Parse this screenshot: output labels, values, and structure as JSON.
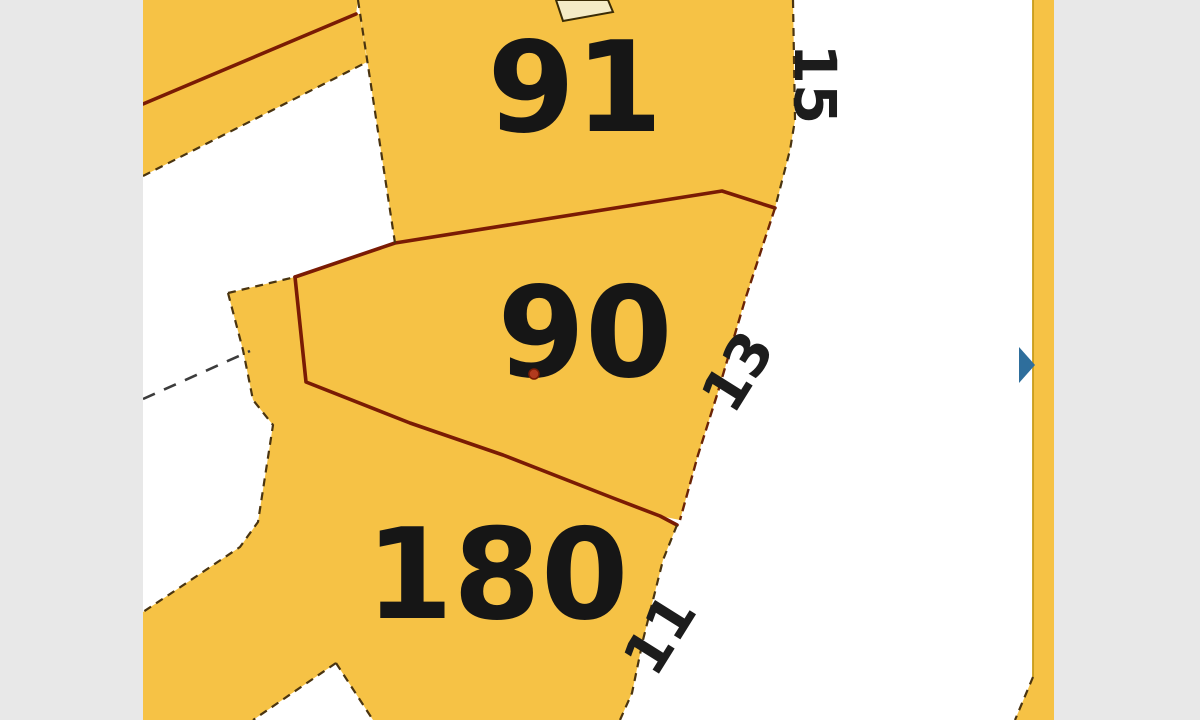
{
  "labels": {
    "p91": "91",
    "p90": "90",
    "p180": "180"
  },
  "street_numbers": {
    "n15": "15",
    "n13": "13",
    "n11": "11"
  },
  "markers": {
    "selected_point": "red-dot-marker",
    "arrow": "blue-right-arrow"
  },
  "colors": {
    "parcel_fill": "#f6c245",
    "building_fill": "#f4ebc6",
    "road_white": "#ffffff",
    "boundary_red": "#7a1b04",
    "frontage_dark": "#4a3410",
    "letterbox_gray": "#e8e8e8",
    "text_black": "#161616",
    "arrow_blue": "#2e6e9c",
    "dot_red": "#b23a1e"
  }
}
